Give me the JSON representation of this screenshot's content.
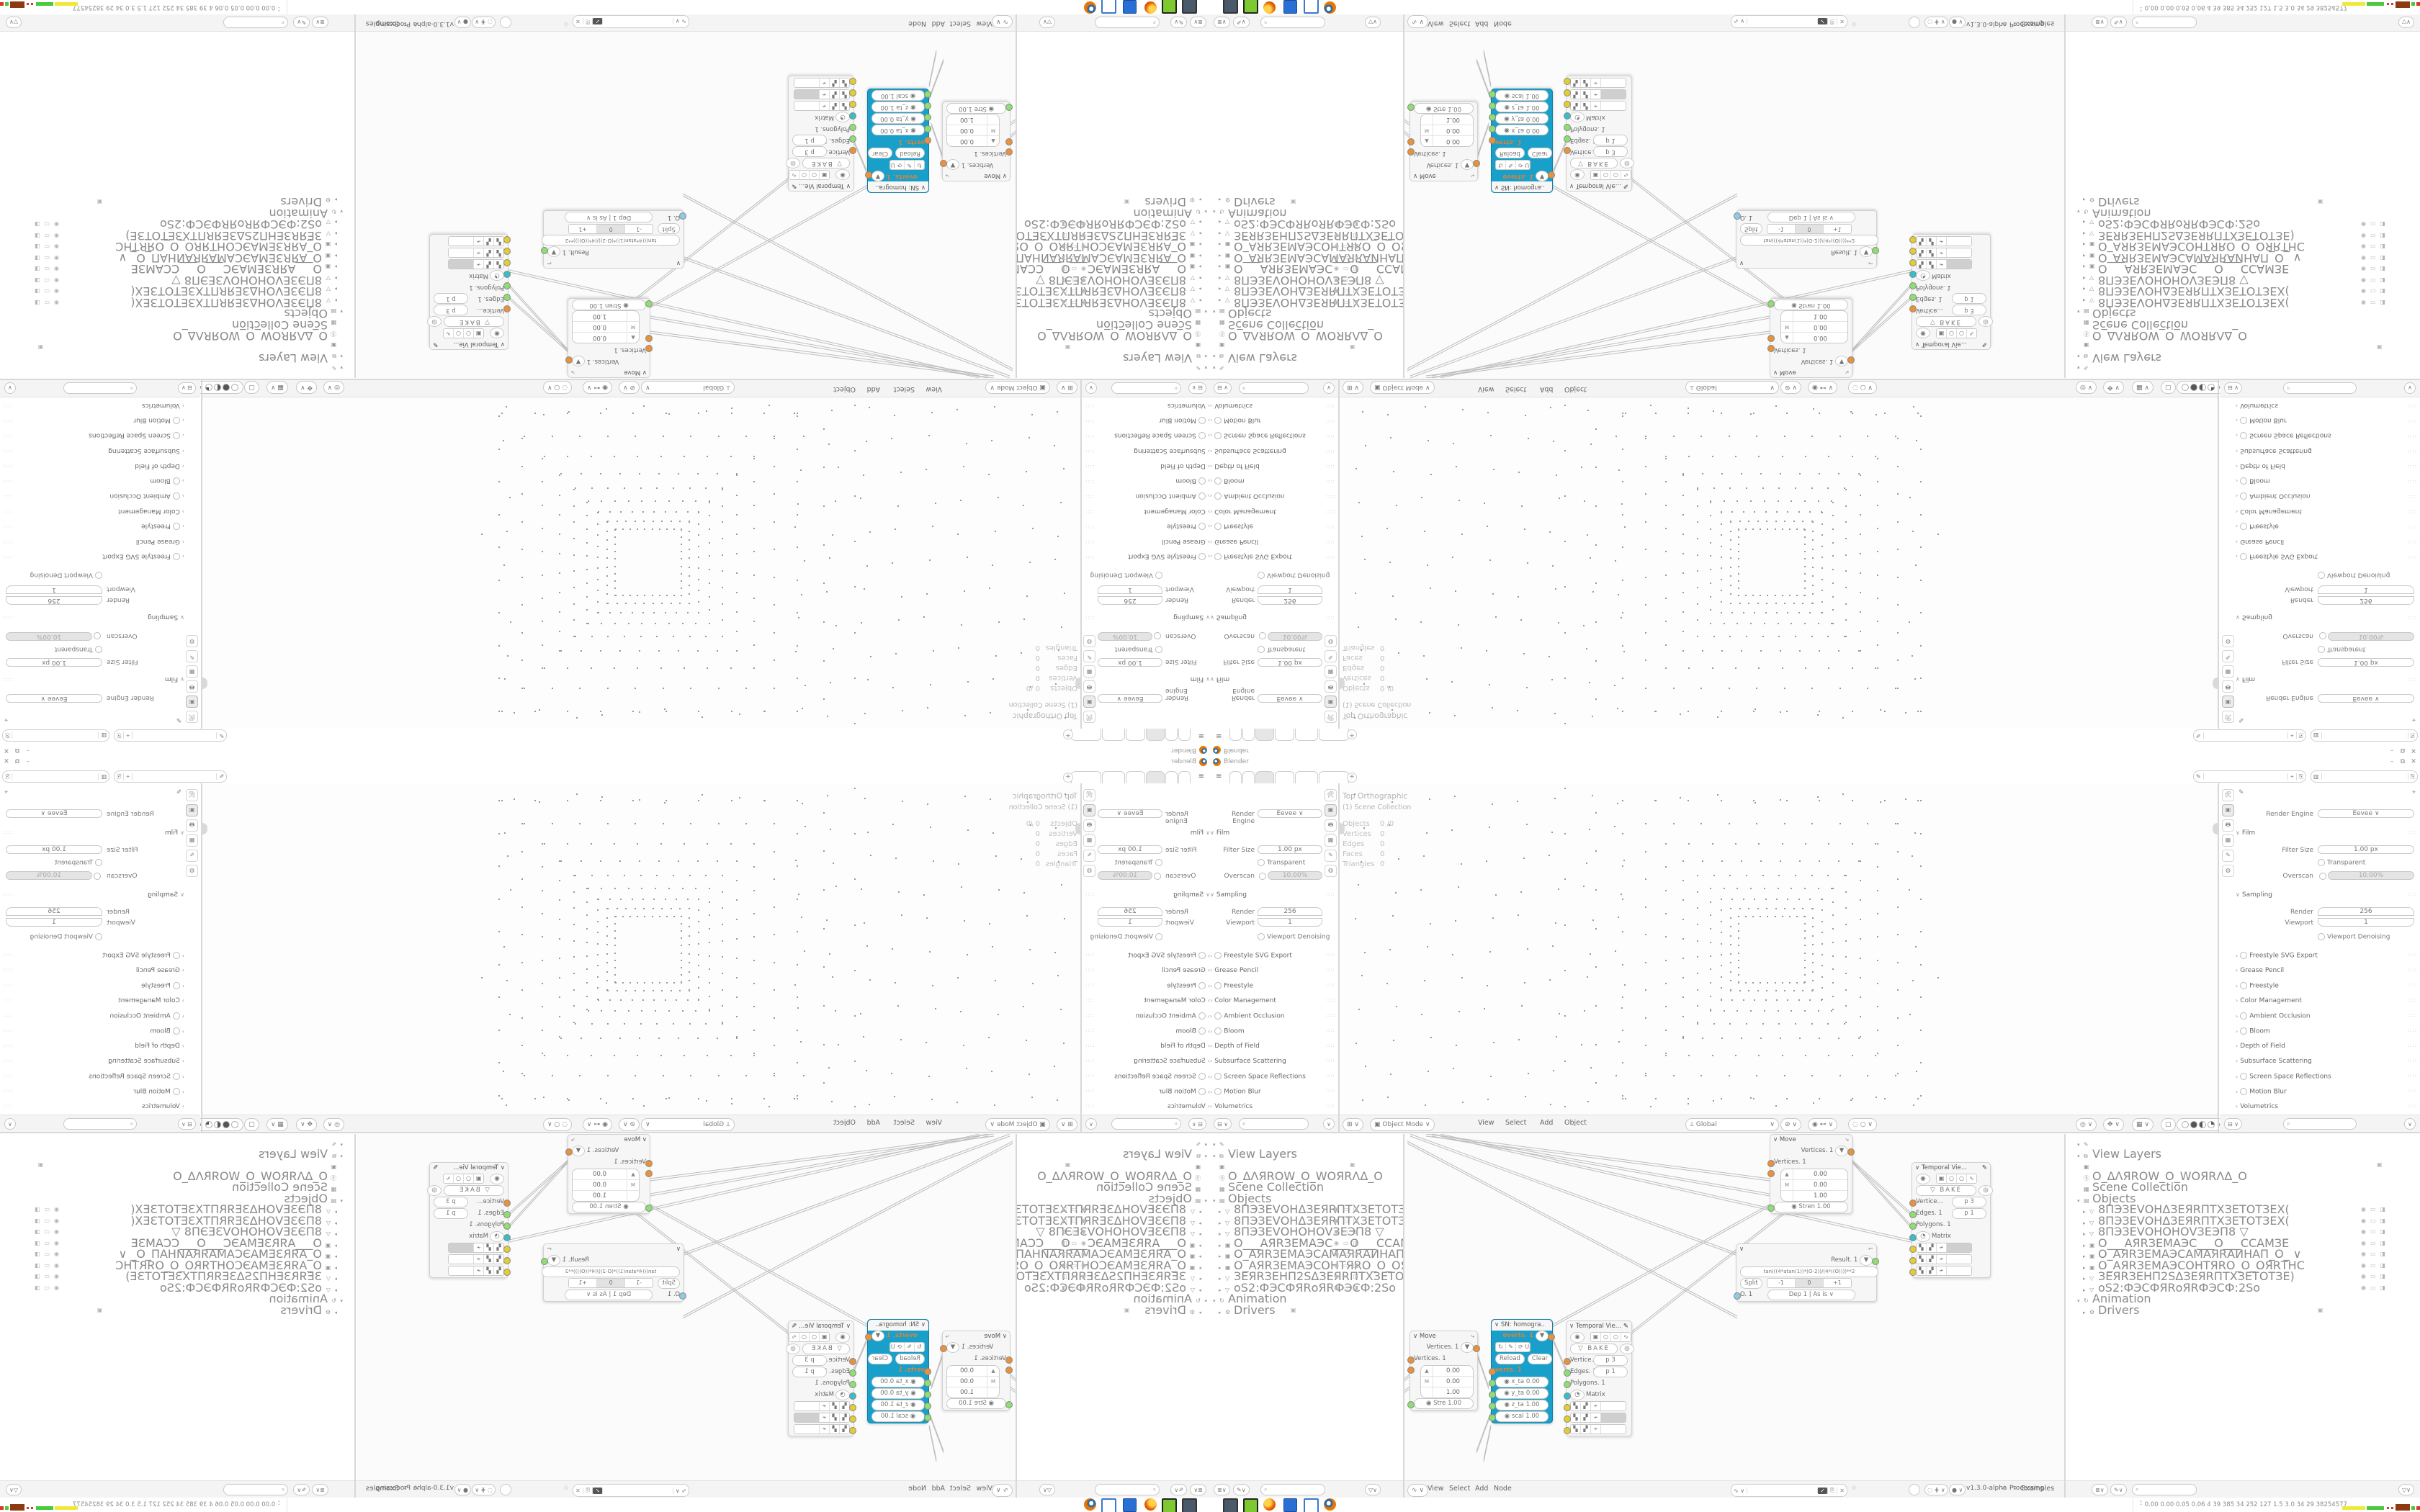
{
  "window": {
    "title": "Blender",
    "minimize": "–",
    "maximize": "⧉",
    "close": "✕"
  },
  "topbar": {
    "hamburger": "≡",
    "tabs": [
      "",
      "",
      "",
      "",
      "",
      ""
    ],
    "active_tab_index": 2,
    "new_tab": "+",
    "id_selectors": [
      {
        "icon": "✎",
        "value": "",
        "buttons": [
          "⌖",
          "⎘"
        ]
      },
      {
        "icon": "▥",
        "value": "",
        "buttons": [
          "⎘"
        ]
      }
    ]
  },
  "properties": {
    "render_engine_label": "Render Engine",
    "render_engine_value": "Eevee",
    "film_label": "Film",
    "filter_size_label": "Filter Size",
    "filter_size_value": "1.00 px",
    "transparent_label": "Transparent",
    "overscan_label": "Overscan",
    "overscan_value": "10.00%",
    "sampling_label": "Sampling",
    "render_label": "Render",
    "render_value": "256",
    "viewport_label": "Viewport",
    "viewport_value": "1",
    "denoising_label": "Viewport Denoising",
    "collapsed_sections": [
      {
        "label": "Freestyle SVG Export",
        "checkbox": true
      },
      {
        "label": "Grease Pencil",
        "checkbox": false
      },
      {
        "label": "Freestyle",
        "checkbox": true
      },
      {
        "label": "Color Management",
        "checkbox": false
      },
      {
        "label": "Ambient Occlusion",
        "checkbox": true
      },
      {
        "label": "Bloom",
        "checkbox": true
      },
      {
        "label": "Depth of Field",
        "checkbox": false
      },
      {
        "label": "Subsurface Scattering",
        "checkbox": false
      },
      {
        "label": "Screen Space Reflections",
        "checkbox": true
      },
      {
        "label": "Motion Blur",
        "checkbox": true
      },
      {
        "label": "Volumetrics",
        "checkbox": false
      }
    ],
    "tab_icons": [
      "🛠",
      "▣",
      "🖶",
      "▦",
      "✎",
      "◍"
    ]
  },
  "viewport": {
    "overlay_line1": "Top Orthographic",
    "overlay_line2": "(1) Scene Collection",
    "overlay_stats": [
      {
        "k": "Objects",
        "v": "0 /0"
      },
      {
        "k": "Vertices",
        "v": "0"
      },
      {
        "k": "Edges",
        "v": "0"
      },
      {
        "k": "Faces",
        "v": "0"
      },
      {
        "k": "Triangles",
        "v": "0"
      }
    ],
    "header": {
      "editor_icon": "⊞",
      "mode_icon": "▣",
      "mode": "Object Mode",
      "menus": [
        "View",
        "Select",
        "Add",
        "Object"
      ],
      "orientation_icon": "⟂",
      "orientation": "Global",
      "snap_icon": "⊘",
      "prop_edit_icon": "◉",
      "gizmo_icons": [
        "◎",
        "✥",
        "▦",
        "▢"
      ]
    }
  },
  "outliner": {
    "root_icon": "✎",
    "view_layers_label": "View Layers",
    "camera_icon": "▣",
    "scene_name": "O_ΔΛЯROW_O_WOЯRΛΔ_O",
    "scene_collection_label": "Scene Collection",
    "objects_label": "Objects",
    "objects": [
      {
        "icon": "▽",
        "name": "8ПЭЗЕVОНΔЗЕЯRПТХЗЕТОТЗЕХ("
      },
      {
        "icon": "▽",
        "name": "8ПЭЗЕVОНΔЗЕЯRПТХЗЕТОТЗЕХ("
      },
      {
        "icon": "▽",
        "name": "8ПЭЗЕVОНОНОVЗЕЭП8    ▽"
      },
      {
        "icon": "▣",
        "name": "О___АЯRЗЕМАЭС___О___ССАМЗЕ"
      },
      {
        "icon": "▣",
        "name": "О_АЯRЗЕМАЭСАМАЯRАИНАП_О_ ∨"
      },
      {
        "icon": "▣",
        "name": "О_АЯRЗЕМАЭСОНТЯRО_О_ОЯRТНС"
      },
      {
        "icon": "▽",
        "name": "ЗЕЯRЗЕНП2SΔЗЕЯRПТХЗЕТОТЗЕ)"
      },
      {
        "icon": "▽",
        "name": "оЅ2:ФЭСФЯRоЯRФЭСФ:2Ѕо"
      }
    ],
    "animation_label": "Animation",
    "drivers_label": "Drivers",
    "toggle_icons": [
      "◉",
      "▭",
      "◨"
    ],
    "header": {
      "display_icon": "≣",
      "filter_icon": "✎",
      "funnel_icon": "▽"
    }
  },
  "node_editor": {
    "header": {
      "editor_icon": "∿",
      "menus": [
        "View",
        "Select",
        "Add",
        "Node"
      ],
      "tree_field": "",
      "shield_icon": "✓",
      "buttons": [
        "⎘",
        "✕",
        "☆"
      ],
      "version": "v1.3.0-alpha",
      "sv_icon": "∿",
      "examples": "Examples",
      "processing": "Processing"
    }
  },
  "nodes": {
    "move": {
      "title": "Move",
      "corner_icon": "⤷",
      "out_label": "Vertices. 1",
      "in_label": "Vertices. 1",
      "vec_rows": [
        [
          "▲",
          "0.00"
        ],
        [
          "M",
          "0.00"
        ],
        [
          "",
          "1.00"
        ]
      ],
      "strength1": "Stren  1.00",
      "strength2": "Stre   1.00"
    },
    "formula": {
      "corner_icon": "⌐",
      "result_label": "Result. 1",
      "formula": "tan(((4*atan(1))*(O-2))/(4*((O))))**2",
      "split": "Split",
      "stepper": [
        "-1",
        "0",
        "+1"
      ],
      "out_label": "O. 1",
      "dep": "Dep  1",
      "wrap": "As is"
    },
    "homography": {
      "title": "SN: homogra..",
      "title_icon": "☯",
      "overts": "overts. 1",
      "update_icons": [
        "↻",
        "✎"
      ],
      "update": "Updat...",
      "reload": "Reload",
      "clear": "Clear",
      "verts": "verts. 1",
      "fields": [
        [
          "x_ta",
          "0.00"
        ],
        [
          "y_ta",
          "0.00"
        ],
        [
          "z_ta",
          "1.00"
        ],
        [
          "scal",
          "1.00"
        ]
      ]
    },
    "temporal": {
      "title": "Temporal Vie...",
      "title_icon": "✎",
      "toggle_cells": [
        "▣",
        "○",
        "○",
        "∿"
      ],
      "bake": "BAKE",
      "bake_icon": "▽",
      "ring_icon": "◎",
      "sockets": [
        {
          "c": "s-or",
          "label": "Vertice...",
          "pill": "p  3"
        },
        {
          "c": "s-gr",
          "label": "Edges. 1",
          "pill": "p  1"
        },
        {
          "c": "s-gr",
          "label": "Polygons. 1",
          "pill": ""
        },
        {
          "c": "s-cy",
          "label": "Matrix",
          "pill": "",
          "pre": "◔"
        }
      ],
      "widget_icons": [
        "▚",
        "▞",
        "≁"
      ]
    }
  },
  "taskbar": {
    "stats_prefix": "⌃",
    "stats": "0.00 0.00 0.05 0.06   4    39   385   34   252  127   1.5   3.0   34    29  38254577"
  },
  "colors": {
    "selected_node": "#189fca",
    "socket_orange": "#e8923c",
    "socket_green": "#8ede72",
    "socket_cyan": "#35bfc9",
    "socket_yellow": "#e3cd32",
    "socket_blue": "#8ec9e8",
    "swatch_yellow": "#f0e93c",
    "swatch_green": "#49c93c",
    "swatch_red": "#d8382a",
    "swatch_maroon": "#8e3a10",
    "blender_orange": "#ea7600"
  }
}
